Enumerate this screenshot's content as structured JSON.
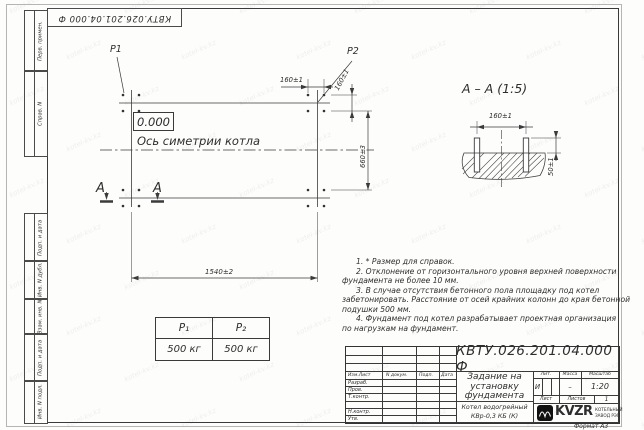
{
  "watermark": "kotel-kv.kz",
  "frame_labels": [
    "Перв. примен.",
    "Справ. N",
    "Подп. и дата",
    "Инв. N дубл.",
    "Взам. инв. N",
    "Подп. и дата",
    "Инв. N подл."
  ],
  "plan": {
    "p1": "P1",
    "p2": "P2",
    "elevation": "0.000",
    "axis_label": "Ось симетрии котла",
    "section_letter": "А",
    "dims": {
      "spacing": "160±1",
      "height": "660±3",
      "width": "1540±2"
    }
  },
  "section_view": {
    "title": "А – А (1:5)",
    "width_dim": "160±1",
    "height_dim": "50±1"
  },
  "loads_table": {
    "columns": [
      {
        "header": "P₁",
        "value": "500 кг"
      },
      {
        "header": "P₂",
        "value": "500 кг"
      }
    ]
  },
  "notes": {
    "lines": [
      "1. * Размер для справок.",
      "2. Отклонение от горизонтального уровня верхней поверхности",
      "фундамента не более 10 мм.",
      "3. В случае отсутствия бетонного пола площадку под котел",
      "забетонировать. Расстояние от осей крайних колонн до края бетонной",
      "подушки 500 мм.",
      "4. Фундамент под котел разрабатывает проектная организация",
      "по нагрузкам на фундамент."
    ]
  },
  "title_block": {
    "doc_number": "КВТУ.026.201.04.000 Ф",
    "name_lines": [
      "Задание на",
      "установку",
      "фундамента"
    ],
    "product_lines": [
      "Котел водогрейный",
      "КВр-0,3 КБ (К)"
    ],
    "headers": {
      "izm": "Изм.Лист",
      "doc": "N докум.",
      "podp": "Подп.",
      "data": "Дата",
      "lit": "Лит.",
      "massa": "Масса",
      "masshtab": "Масштаб",
      "list": "Лист",
      "listov": "Листов"
    },
    "rows": [
      "Разраб.",
      "Пров.",
      "Т.контр.",
      "",
      "Н.контр.",
      "Утв."
    ],
    "lit_value": "И",
    "massa_value": "–",
    "scale_value": "1:20",
    "listov_value": "1",
    "company": {
      "name": "KVZR",
      "tagline1": "КОТЕЛЬНЫЙ",
      "tagline2": "ЗАВОД РЭП"
    },
    "format_note": "Формат А3"
  }
}
